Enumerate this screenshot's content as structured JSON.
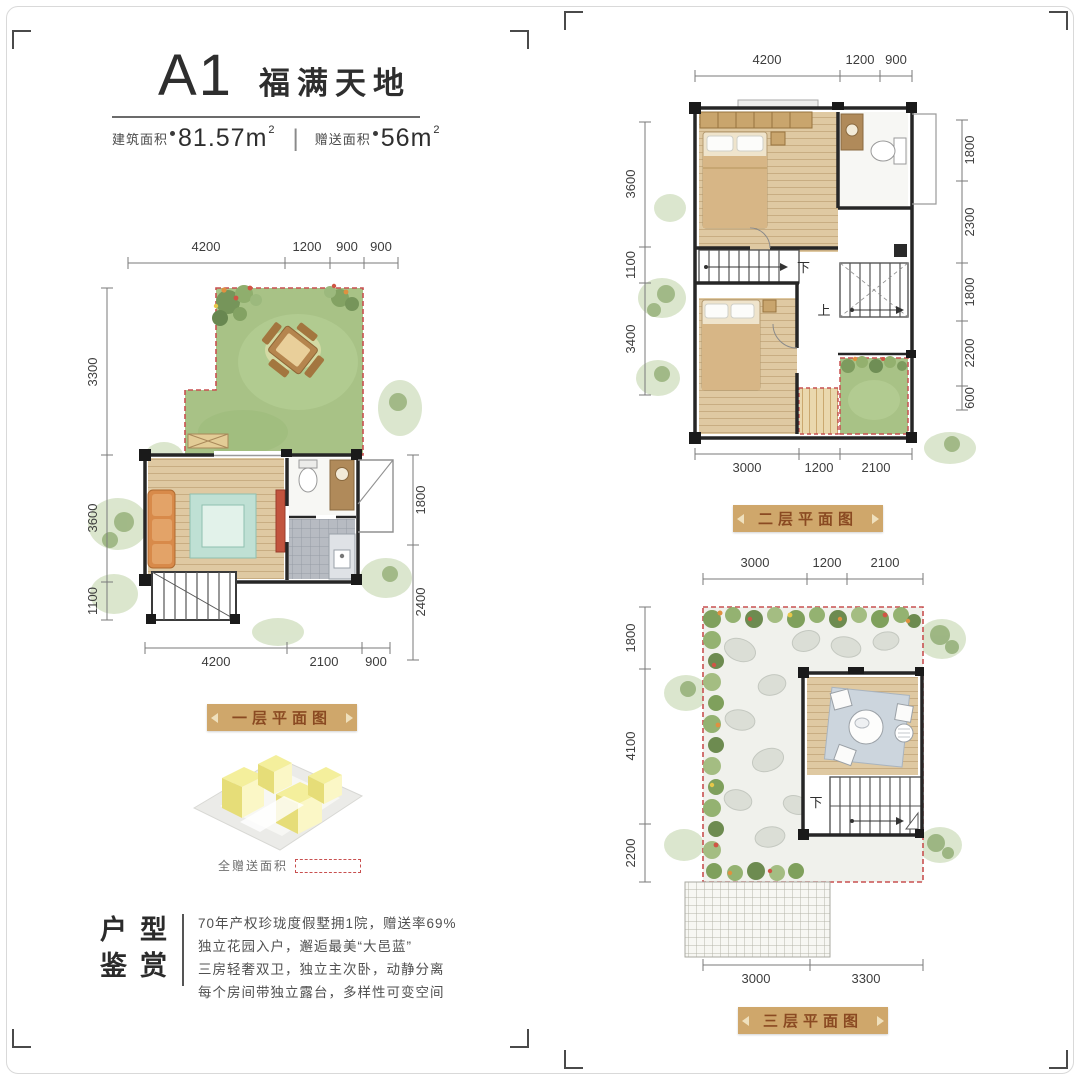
{
  "header": {
    "unit": "A1",
    "title": "福满天地",
    "area1_label": "建筑面积",
    "area1_value": "81.57m",
    "area1_sup": "2",
    "divider": "|",
    "area2_label": "赠送面积",
    "area2_value": "56m",
    "area2_sup": "2"
  },
  "floor1": {
    "banner": "一层平面图",
    "dims_top": [
      "4200",
      "1200",
      "900",
      "900"
    ],
    "dims_left": [
      "3300",
      "3600",
      "1100"
    ],
    "dims_right": [
      "1800",
      "2400"
    ],
    "dims_bottom": [
      "4200",
      "2100",
      "900"
    ]
  },
  "floor2": {
    "banner": "二层平面图",
    "dims_top": [
      "4200",
      "1200",
      "900"
    ],
    "dims_left": [
      "3600",
      "1100",
      "3400"
    ],
    "dims_right": [
      "1800",
      "2300",
      "1800",
      "2200",
      "600"
    ],
    "dims_bottom": [
      "3000",
      "1200",
      "2100"
    ],
    "stairs_down": "下",
    "stairs_up": "上"
  },
  "floor3": {
    "banner": "三层平面图",
    "dims_top": [
      "3000",
      "1200",
      "2100"
    ],
    "dims_left": [
      "1800",
      "4100",
      "2200"
    ],
    "dims_bottom": [
      "3000",
      "3300"
    ],
    "stairs_down": "下"
  },
  "legend": {
    "gift_label": "全赠送面积"
  },
  "description": {
    "title_line1": "户型",
    "title_line2": "鉴赏",
    "lines": [
      "70年产权珍珑度假墅拥1院，赠送率69%",
      "独立花园入户，邂逅最美“大邑蓝”",
      "三房轻奢双卫，独立主次卧，动静分离",
      "每个房间带独立露台，多样性可变空间"
    ]
  },
  "colors": {
    "banner_bg": "#cfa76b",
    "banner_text": "#8a4a22",
    "gift_dash": "#c85050",
    "garden_green": "#a8c286",
    "wood_floor": "#dfc9a2",
    "kitchen_tile": "#b7bbc2"
  }
}
